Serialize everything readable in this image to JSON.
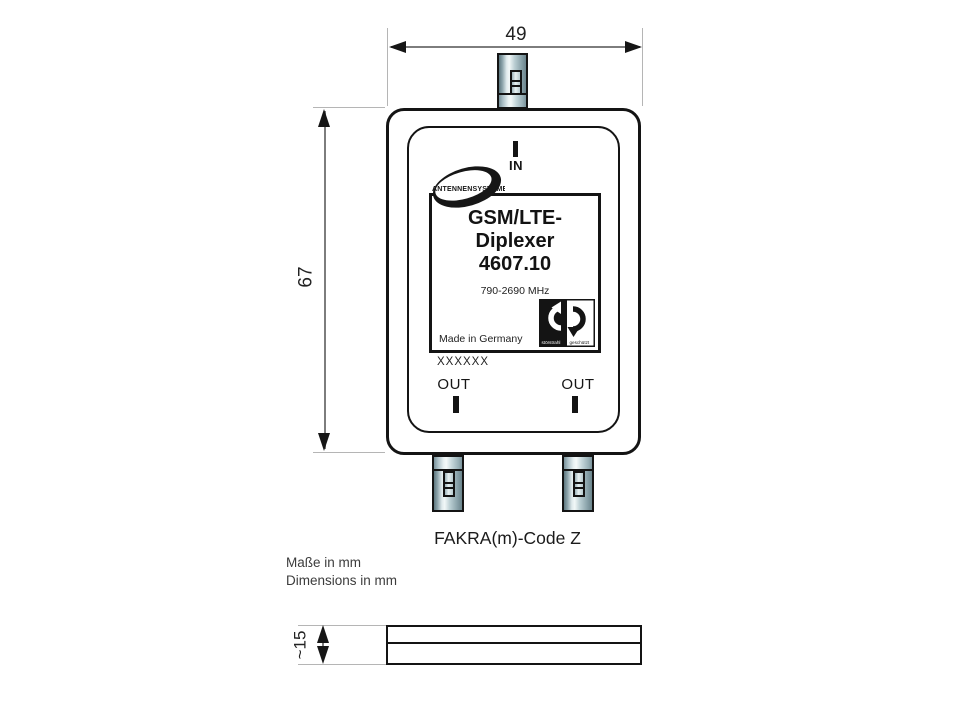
{
  "dimensions": {
    "width_mm": "49",
    "height_mm": "67",
    "depth_mm": "~15"
  },
  "ports": {
    "in": "IN",
    "out_left": "OUT",
    "out_right": "OUT"
  },
  "label": {
    "brand": "ANTENNENSYSTEME",
    "product_line1": "GSM/LTE-",
    "product_line2": "Diplexer",
    "model": "4607.10",
    "frequency_range": "790-2690 MHz",
    "origin": "Made in Germany",
    "emc_left": "störstrahl",
    "emc_right": "geschützt"
  },
  "serial_placeholder": "XXXXXX",
  "connector_note": "FAKRA(m)-Code Z",
  "units": {
    "de": "Maße in mm",
    "en": "Dimensions in mm"
  },
  "colors": {
    "outline": "#141414",
    "dim_line": "#7d7d7d",
    "extension_line": "#b5b5b5",
    "metal_dark": "#5e777f",
    "metal_highlight": "#f2f8f8",
    "text": "#1c1c1c"
  }
}
